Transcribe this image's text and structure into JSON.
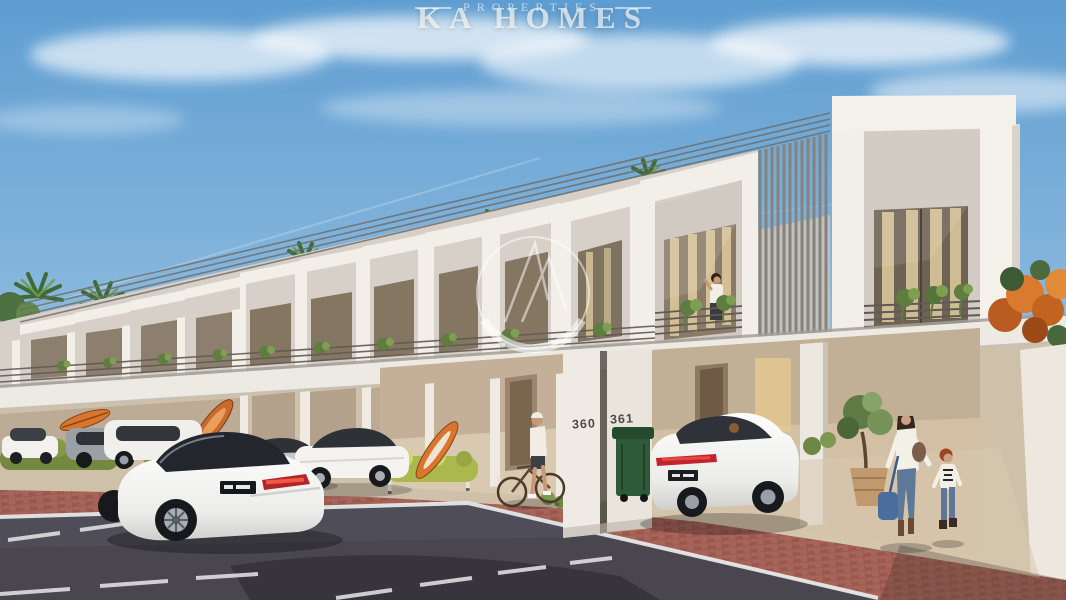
{
  "scene": {
    "kind": "architectural-render",
    "alt": "Sunny street view of a row of modern white two-storey townhouses with parked cars, a cyclist and a family walking",
    "house_numbers": {
      "left": "360",
      "right": "361"
    }
  },
  "watermark": {
    "brand": "KA HOMES",
    "tagline": "PROPERTIES"
  },
  "palette": {
    "sky_top": "#5e9dd1",
    "sky_horizon": "#cfe3f0",
    "facade": "#f2efe8",
    "facade_recess": "#d4cec6",
    "porch": "#c9b69c",
    "road": "#49464f",
    "pavers": "#a2615a",
    "driveway": "#d8c7ad",
    "hedge": "#87994a",
    "taillight_red": "#bf2430",
    "bin_green": "#2e5a39",
    "blossom_orange": "#d97a2e"
  }
}
